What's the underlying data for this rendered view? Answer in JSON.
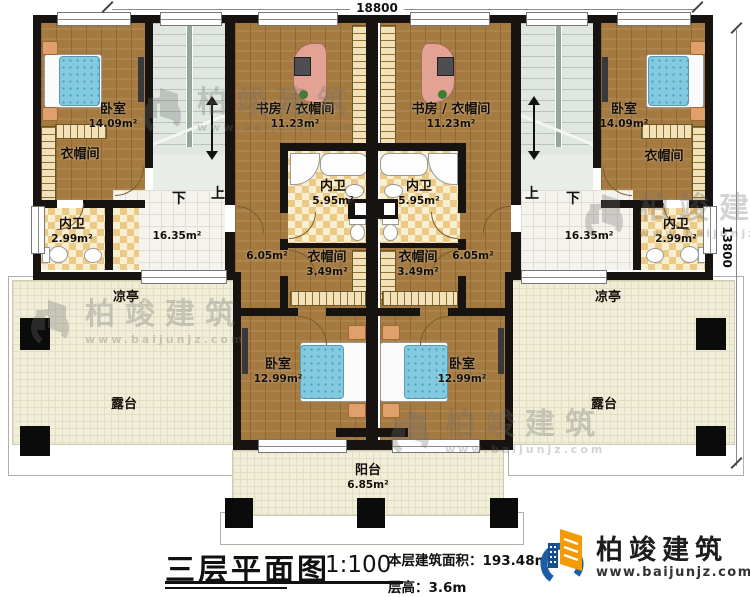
{
  "title_block": {
    "title": "三层平面图",
    "scale": "1:100",
    "area_label": "本层建筑面积：",
    "area_value": "193.48m²",
    "height_label": "层高：",
    "height_value": "3.6m"
  },
  "dimensions": {
    "top": "18800",
    "right": "13800"
  },
  "stairs": {
    "up": "上",
    "down": "下"
  },
  "rooms": {
    "bedroom_top": {
      "label": "卧室",
      "area": "14.09m²"
    },
    "bedroom_bottom": {
      "label": "卧室",
      "area": "12.99m²"
    },
    "study": {
      "label": "书房 / 衣帽间",
      "area": "11.23m²"
    },
    "cloakroom": {
      "label": "衣帽间"
    },
    "cloakroom_inner": {
      "label": "衣帽间",
      "area": "3.49m²"
    },
    "bath_inner": {
      "label": "内卫",
      "area": "5.95m²"
    },
    "bath_outer": {
      "label": "内卫",
      "area": "2.99m²"
    },
    "hall": {
      "area": "16.35m²"
    },
    "corridor": {
      "area": "6.05m²"
    },
    "pavilion": {
      "label": "凉亭"
    },
    "terrace": {
      "label": "露台"
    },
    "balcony": {
      "label": "阳台",
      "area": "6.85m²"
    }
  },
  "branding": {
    "name": "柏竣建筑",
    "website": "www.baijunjz.com"
  }
}
